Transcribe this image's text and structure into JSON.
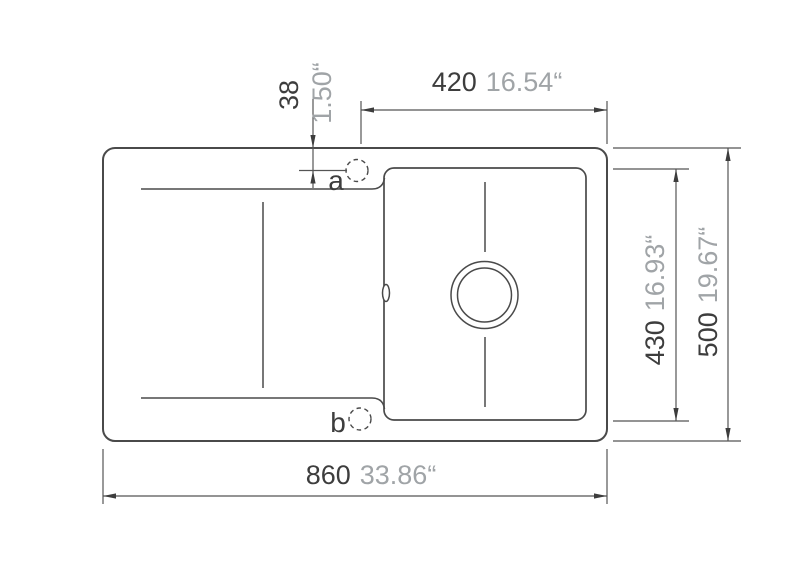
{
  "diagram": {
    "kind": "sink-top-view-dimension-drawing",
    "dims": {
      "tap_hole_offset": {
        "mm": "38",
        "inch": "1.50“"
      },
      "top_width": {
        "mm": "420",
        "inch": "16.54“"
      },
      "inner_height": {
        "mm": "430",
        "inch": "16.93“"
      },
      "outer_height": {
        "mm": "500",
        "inch": "19.67“"
      },
      "overall_width": {
        "mm": "860",
        "inch": "33.86“"
      }
    },
    "hole_labels": {
      "a": "a",
      "b": "b"
    },
    "colors": {
      "line": "#4a4a4a",
      "dimension_line": "#555555",
      "mm_text": "#3d3d3d",
      "inch_text": "#a0a4a7",
      "background": "#ffffff"
    }
  }
}
